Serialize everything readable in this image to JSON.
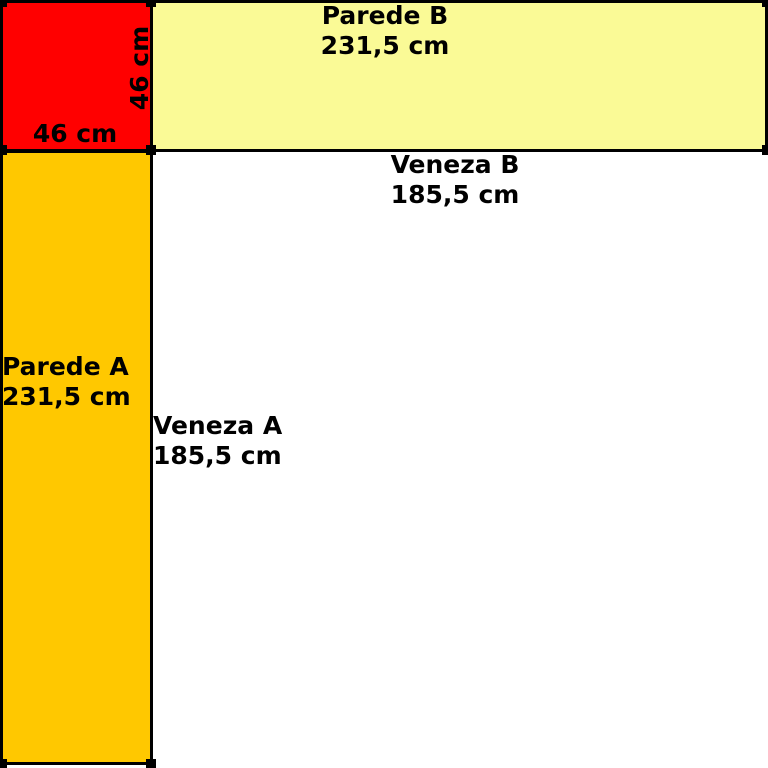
{
  "diagram": {
    "background_color": "#ffffff",
    "line_color": "#000000",
    "corner_square": {
      "color": "#ff0000",
      "width_label": "46 cm",
      "height_label": "46 cm"
    },
    "parede_b": {
      "title": "Parede B",
      "length": "231,5 cm",
      "color": "#fafa96"
    },
    "parede_a": {
      "title": "Parede A",
      "length": "231,5 cm",
      "color": "#ffc800"
    },
    "veneza_b": {
      "title": "Veneza B",
      "length": "185,5 cm"
    },
    "veneza_a": {
      "title": "Veneza A",
      "length": "185,5 cm"
    }
  }
}
